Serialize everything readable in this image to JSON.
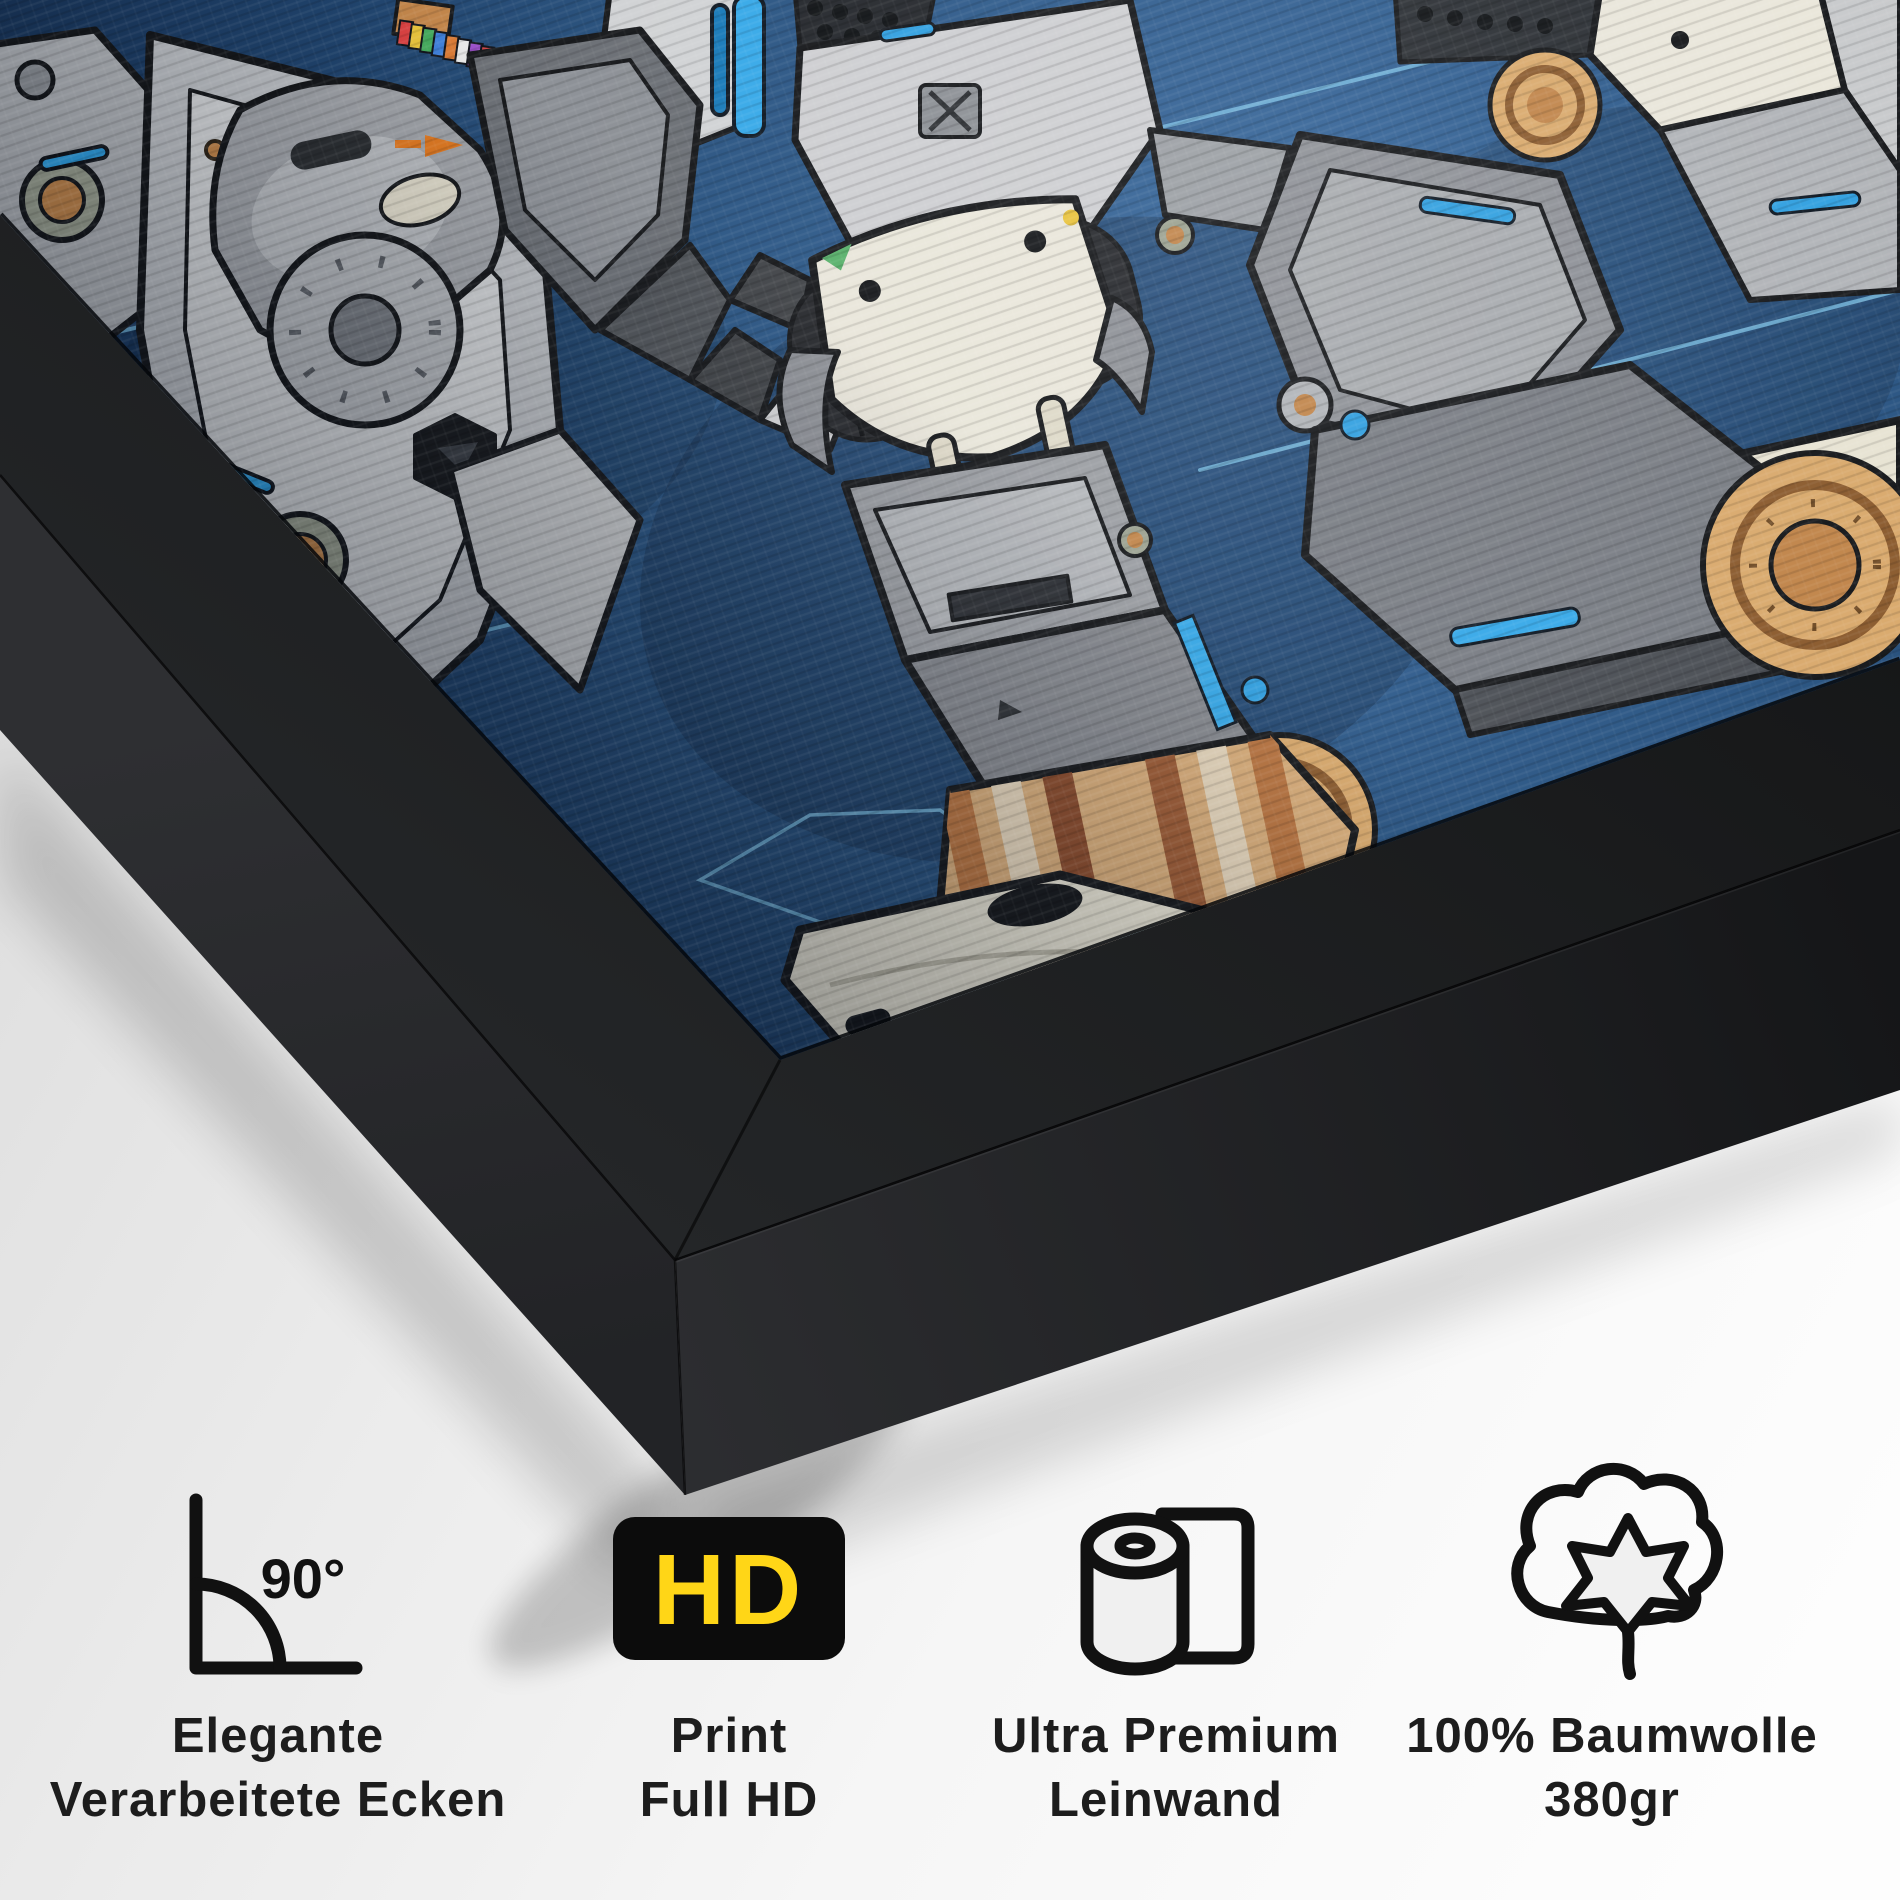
{
  "scene": {
    "artwork_alt": "sci-fi mecha robot legs on navy blueprint canvas in black box frame"
  },
  "features": [
    {
      "icon": "right-angle-90-icon",
      "icon_label": "90°",
      "lines": [
        "Elegante",
        "Verarbeitete Ecken"
      ]
    },
    {
      "icon": "hd-badge-icon",
      "badge_text": "HD",
      "lines": [
        "Print",
        "Full HD"
      ]
    },
    {
      "icon": "canvas-roll-icon",
      "lines": [
        "Ultra Premium",
        "Leinwand"
      ]
    },
    {
      "icon": "cotton-flower-icon",
      "lines": [
        "100% Baumwolle",
        "380gr"
      ]
    }
  ],
  "colors": {
    "background": "#f0f0f0",
    "frame_front": "#1a1b1d",
    "frame_side_left": "#2a2b2e",
    "frame_side_bottom": "#232427",
    "canvas_navy": "#27517e",
    "blueprint_cyan": "#7cc2e6",
    "mecha_accent_blue": "#2f9fe0",
    "armor_light_gray": "#c7c9cb",
    "armor_cream": "#e9e6da",
    "foot_tan": "#d9ad79",
    "bronze": "#c08449",
    "hd_badge_bg": "#0c0c0c",
    "hd_yellow": "#FFD617",
    "icon_black": "#111111",
    "label_text": "#1d1d1d"
  }
}
